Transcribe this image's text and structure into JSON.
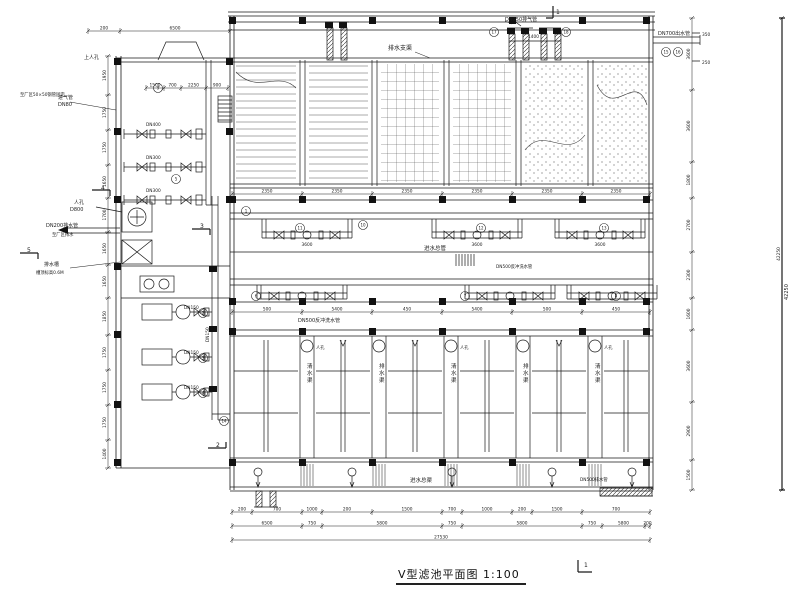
{
  "meta": {
    "drawing_title": "V型滤池平面图 1:100",
    "scale": "1:100",
    "sheet_marker": "1"
  },
  "colors": {
    "line": "#1a1a1a",
    "bg": "#ffffff",
    "solid": "#111111"
  },
  "labels": [
    {
      "x": 388,
      "y": 50,
      "t": "排水支渠",
      "s": 6
    },
    {
      "x": 505,
      "y": 21,
      "t": "DN250排气管",
      "s": 5
    },
    {
      "x": 658,
      "y": 35,
      "t": "DN700出水管",
      "s": 5
    },
    {
      "x": 58,
      "y": 99,
      "t": "进气管",
      "s": 5
    },
    {
      "x": 58,
      "y": 106,
      "t": "DN80",
      "s": 5
    },
    {
      "x": 20,
      "y": 96,
      "t": "至厂区50×50钢管固定",
      "s": 4.3
    },
    {
      "x": 84,
      "y": 59,
      "t": "上人孔",
      "s": 5
    },
    {
      "x": 74,
      "y": 204,
      "t": "人孔",
      "s": 5
    },
    {
      "x": 70,
      "y": 211,
      "t": "D800",
      "s": 5
    },
    {
      "x": 46,
      "y": 227,
      "t": "DN200排水管",
      "s": 5
    },
    {
      "x": 52,
      "y": 236,
      "t": "至厂区排水",
      "s": 4.3
    },
    {
      "x": 44,
      "y": 266,
      "t": "排水槽",
      "s": 5
    },
    {
      "x": 36,
      "y": 274,
      "t": "槽顶标高0.6M",
      "s": 4.3
    },
    {
      "x": 424,
      "y": 250,
      "t": "进水总管",
      "s": 5.5
    },
    {
      "x": 298,
      "y": 322,
      "t": "DN500反冲洗水管",
      "s": 5
    },
    {
      "x": 496,
      "y": 268,
      "t": "DN500反冲洗水管",
      "s": 4.3
    },
    {
      "x": 184,
      "y": 309,
      "t": "DN150",
      "s": 4.3
    },
    {
      "x": 184,
      "y": 354,
      "t": "DN150",
      "s": 4.3
    },
    {
      "x": 184,
      "y": 389,
      "t": "DN150",
      "s": 4.3
    },
    {
      "x": 209,
      "y": 342,
      "t": "DN150",
      "s": 4.3,
      "r": -90
    },
    {
      "x": 146,
      "y": 126,
      "t": "DN400",
      "s": 4.3
    },
    {
      "x": 146,
      "y": 159,
      "t": "DN300",
      "s": 4.3
    },
    {
      "x": 146,
      "y": 192,
      "t": "DN300",
      "s": 4.3
    },
    {
      "x": 307,
      "y": 368,
      "t": "清水渠",
      "s": 5.5,
      "v": 1
    },
    {
      "x": 379,
      "y": 368,
      "t": "排水渠",
      "s": 5.5,
      "v": 1
    },
    {
      "x": 451,
      "y": 368,
      "t": "清水渠",
      "s": 5.5,
      "v": 1
    },
    {
      "x": 523,
      "y": 368,
      "t": "排水渠",
      "s": 5.5,
      "v": 1
    },
    {
      "x": 595,
      "y": 368,
      "t": "清水渠",
      "s": 5.5,
      "v": 1
    },
    {
      "x": 316,
      "y": 349,
      "t": "人孔",
      "s": 4.3
    },
    {
      "x": 460,
      "y": 349,
      "t": "人孔",
      "s": 4.3
    },
    {
      "x": 604,
      "y": 349,
      "t": "人孔",
      "s": 4.3
    },
    {
      "x": 410,
      "y": 482,
      "t": "进水总渠",
      "s": 5.5
    },
    {
      "x": 580,
      "y": 481,
      "t": "DN500排水管",
      "s": 4.3
    },
    {
      "x": 528,
      "y": 38,
      "t": "1400",
      "s": 4.3
    },
    {
      "x": 702,
      "y": 36,
      "t": "350",
      "s": 4.3
    },
    {
      "x": 702,
      "y": 64,
      "t": "250",
      "s": 4.3
    },
    {
      "x": 788,
      "y": 300,
      "t": "42250",
      "s": 5,
      "r": -90
    },
    {
      "x": 307,
      "y": 246,
      "t": "3600",
      "s": 4.3,
      "a": "middle"
    },
    {
      "x": 477,
      "y": 246,
      "t": "3600",
      "s": 4.3,
      "a": "middle"
    },
    {
      "x": 600,
      "y": 246,
      "t": "3600",
      "s": 4.3,
      "a": "middle"
    },
    {
      "x": 101,
      "y": 190,
      "t": "4",
      "s": 6
    },
    {
      "x": 200,
      "y": 228,
      "t": "3",
      "s": 6
    },
    {
      "x": 27,
      "y": 252,
      "t": "5",
      "s": 6
    },
    {
      "x": 216,
      "y": 447,
      "t": "2",
      "s": 6
    },
    {
      "x": 556,
      "y": 14,
      "t": "1",
      "s": 6
    },
    {
      "x": 584,
      "y": 567,
      "t": "1",
      "s": 6
    }
  ],
  "callouts": [
    {
      "x": 300,
      "y": 228,
      "n": "11"
    },
    {
      "x": 363,
      "y": 225,
      "n": "10"
    },
    {
      "x": 246,
      "y": 211,
      "n": "1"
    },
    {
      "x": 481,
      "y": 228,
      "n": "12"
    },
    {
      "x": 604,
      "y": 228,
      "n": "13"
    },
    {
      "x": 256,
      "y": 296,
      "n": "6"
    },
    {
      "x": 465,
      "y": 296,
      "n": "7"
    },
    {
      "x": 616,
      "y": 296,
      "n": "8"
    },
    {
      "x": 203,
      "y": 313,
      "n": "2"
    },
    {
      "x": 203,
      "y": 358,
      "n": "3"
    },
    {
      "x": 203,
      "y": 393,
      "n": "4"
    },
    {
      "x": 158,
      "y": 88,
      "n": "9"
    },
    {
      "x": 176,
      "y": 179,
      "n": "5"
    },
    {
      "x": 666,
      "y": 52,
      "n": "15"
    },
    {
      "x": 678,
      "y": 52,
      "n": "16"
    },
    {
      "x": 494,
      "y": 32,
      "n": "17"
    },
    {
      "x": 566,
      "y": 32,
      "n": "18"
    },
    {
      "x": 224,
      "y": 421,
      "n": "14"
    }
  ],
  "dims": {
    "top_left": [
      "200",
      "6500"
    ],
    "room": [
      "1500",
      "700",
      "2250",
      "900"
    ],
    "gal1": [
      "2350",
      "2350",
      "2350",
      "2350",
      "2350",
      "2350"
    ],
    "gal2": [
      "500",
      "5400",
      "450",
      "5400",
      "500",
      "450"
    ],
    "bot1": [
      "200",
      "700",
      "1000",
      "200",
      "1500",
      "700",
      "1000",
      "200",
      "1500",
      "700"
    ],
    "bot2": [
      "6500",
      "750",
      "5800",
      "750",
      "5800",
      "750",
      "5800",
      "200"
    ],
    "bot3": [
      "27530"
    ],
    "right1": [
      "3600",
      "3600",
      "1800",
      "2700",
      "2300",
      "1600",
      "3600",
      "2900",
      "1500"
    ],
    "left1": [
      "1950",
      "1750",
      "1750",
      "1650",
      "1700",
      "1650",
      "1650",
      "1850",
      "1750",
      "1750",
      "1750",
      "1400"
    ],
    "right_total": [
      "42250"
    ]
  }
}
